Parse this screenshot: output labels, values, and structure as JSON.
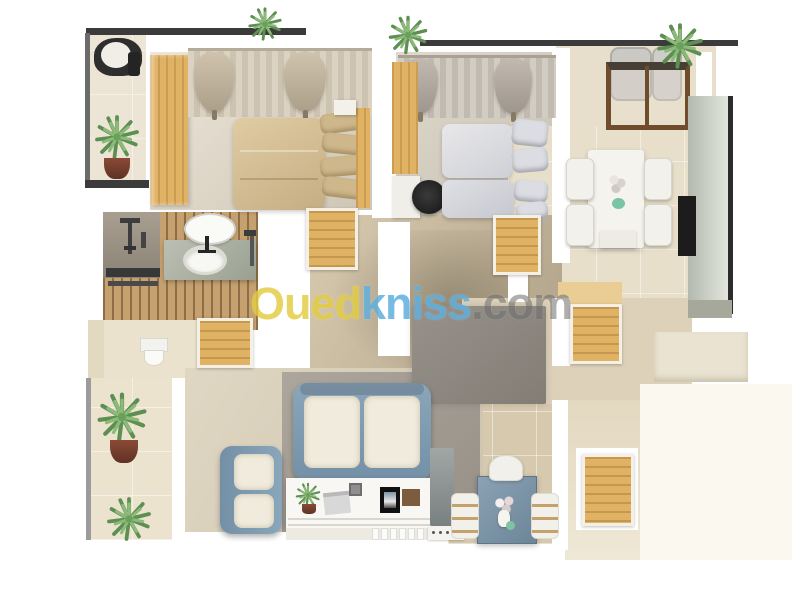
{
  "watermark": {
    "part_oued": "Oued",
    "part_kniss": "kniss",
    "part_com": ".com"
  },
  "colors": {
    "bg": "#ffffff",
    "wood": "#e0b264",
    "slatWood": "#c5a170",
    "railing": "#3b3b3b",
    "rug": "#8e8a83",
    "sofaBlue": "#7e9bb1",
    "cushion": "#f0ebdc",
    "bedBeige": "#d6bf97",
    "pillowBeige": "#cdb78b",
    "bedGray": "#dcdde2",
    "tableBlue": "#7b93a6",
    "plantGreen": "#7fae6e",
    "potBrown": "#74402f",
    "stone": "#aab0a5",
    "shower": "#998f82",
    "grayUnit": "#c8cdc4",
    "tv": "#1c1c1c",
    "wmYellow": "#e3cd3f",
    "wmBlue": "#5fb0e0",
    "wmGray": "#6e6e6e"
  }
}
